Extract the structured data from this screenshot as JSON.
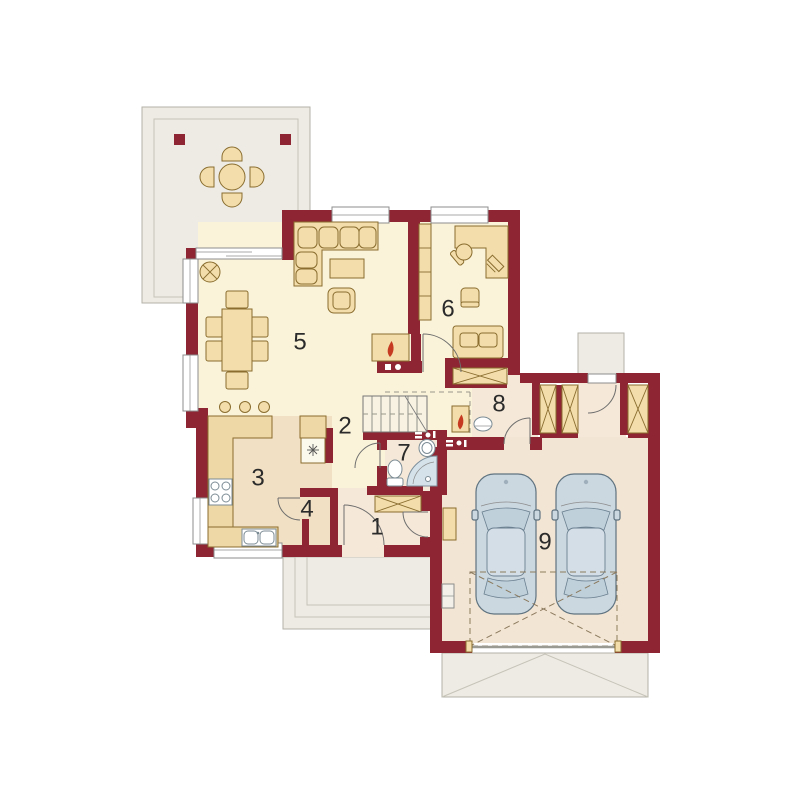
{
  "plan": {
    "type": "house-ground-floor-plan",
    "rooms": [
      {
        "id": "entry-hall",
        "number": "1"
      },
      {
        "id": "hall",
        "number": "2"
      },
      {
        "id": "kitchen",
        "number": "3"
      },
      {
        "id": "pantry",
        "number": "4"
      },
      {
        "id": "living-room",
        "number": "5"
      },
      {
        "id": "office",
        "number": "6"
      },
      {
        "id": "bathroom",
        "number": "7"
      },
      {
        "id": "utility-room",
        "number": "8"
      },
      {
        "id": "garage",
        "number": "9"
      }
    ],
    "garage_cars": 2,
    "terrace_chairs": 4,
    "dining_chairs": 6,
    "bar_stools": 3
  },
  "colors": {
    "wall": "#8d2532",
    "floor_main": "#faf3d9",
    "floor_kitchen": "#f1e0c3",
    "floor_utility": "#f5e8d8",
    "floor_garage": "#f3e5d3",
    "outdoor": "#edebe3",
    "furniture": "#f2ddab",
    "counter": "#eed8a6",
    "furniture_outline": "#8a6d2f",
    "car": "#ccd8e0",
    "water": "#d5e2ea",
    "flame": "#c63a22"
  }
}
